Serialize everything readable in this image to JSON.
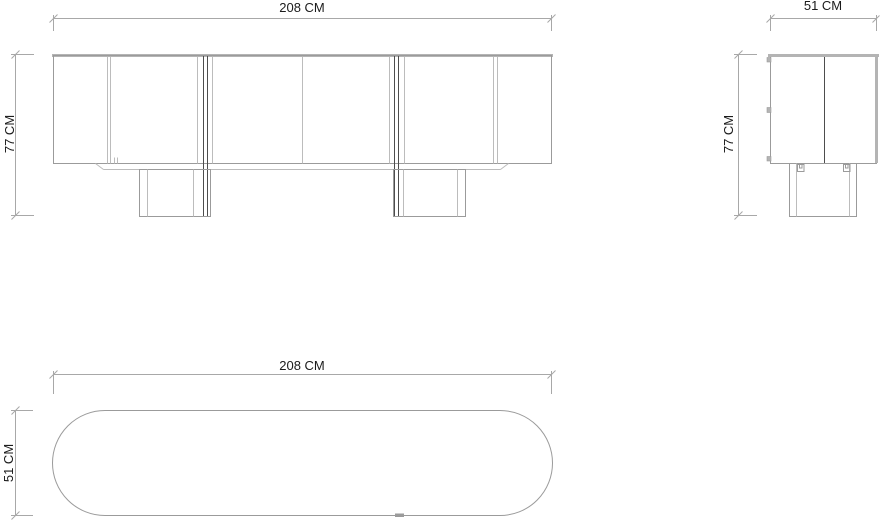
{
  "colors": {
    "background": "#ffffff",
    "outline": "#9b9b9b",
    "light_line": "#bcbcbc",
    "band": "#b4b4b4",
    "dark_line": "#4d4d4d",
    "dimension": "#a8a8a8",
    "text": "#1b1b1b"
  },
  "views": {
    "front": {
      "width_label": "208 CM",
      "height_label": "77 CM"
    },
    "side": {
      "width_label": "51 CM",
      "height_label": "77 CM"
    },
    "plan": {
      "width_label": "208 CM",
      "depth_label": "51 CM"
    }
  }
}
